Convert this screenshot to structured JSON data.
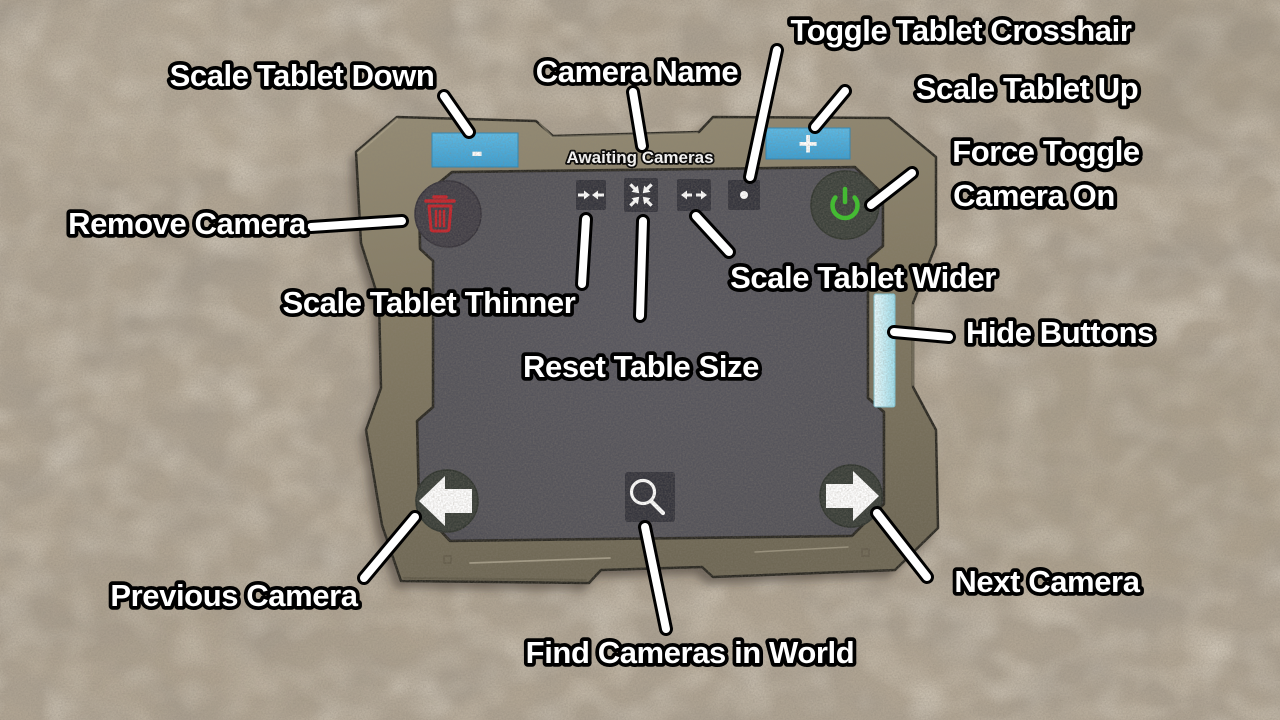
{
  "tablet": {
    "camera_name_text": "Awaiting Cameras",
    "scale_down_glyph": "-",
    "scale_up_glyph": "+"
  },
  "icons": {
    "remove_camera": "trash-icon",
    "force_toggle_camera_on": "power-icon",
    "scale_tablet_thinner": "arrows-inward-icon",
    "reset_table_size": "arrows-collapse-icon",
    "scale_tablet_wider": "arrows-outward-icon",
    "toggle_tablet_crosshair": "dot-icon",
    "previous_camera": "arrow-left-icon",
    "next_camera": "arrow-right-icon",
    "find_cameras_in_world": "magnifier-icon",
    "hide_buttons": "handle-bar"
  },
  "colors": {
    "sand": "#b1a593",
    "frame": "#847b64",
    "frame_shadow": "#5e5747",
    "screen": "#56555e",
    "button_square": "#34343c",
    "button_circle": "#3e423c",
    "accent_blue": "#4badde",
    "accent_cyan": "#c9f0f8",
    "danger_red": "#c4232b",
    "power_green": "#3cc22b",
    "annotation_text": "#ffffff",
    "annotation_outline": "#000000"
  },
  "annotations": [
    {
      "id": "toggle-tablet-crosshair",
      "label": "Toggle Tablet Crosshair"
    },
    {
      "id": "scale-tablet-down",
      "label": "Scale Tablet Down"
    },
    {
      "id": "camera-name",
      "label": "Camera Name"
    },
    {
      "id": "scale-tablet-up",
      "label": "Scale Tablet Up"
    },
    {
      "id": "force-toggle-camera-on",
      "lines": [
        "Force Toggle",
        "Camera On"
      ]
    },
    {
      "id": "remove-camera",
      "label": "Remove Camera"
    },
    {
      "id": "scale-tablet-thinner",
      "label": "Scale Tablet Thinner"
    },
    {
      "id": "scale-tablet-wider",
      "label": "Scale Tablet Wider"
    },
    {
      "id": "reset-table-size",
      "label": "Reset Table Size"
    },
    {
      "id": "hide-buttons",
      "label": "Hide Buttons"
    },
    {
      "id": "previous-camera",
      "label": "Previous Camera"
    },
    {
      "id": "next-camera",
      "label": "Next Camera"
    },
    {
      "id": "find-cameras-in-world",
      "label": "Find Cameras in World"
    }
  ]
}
